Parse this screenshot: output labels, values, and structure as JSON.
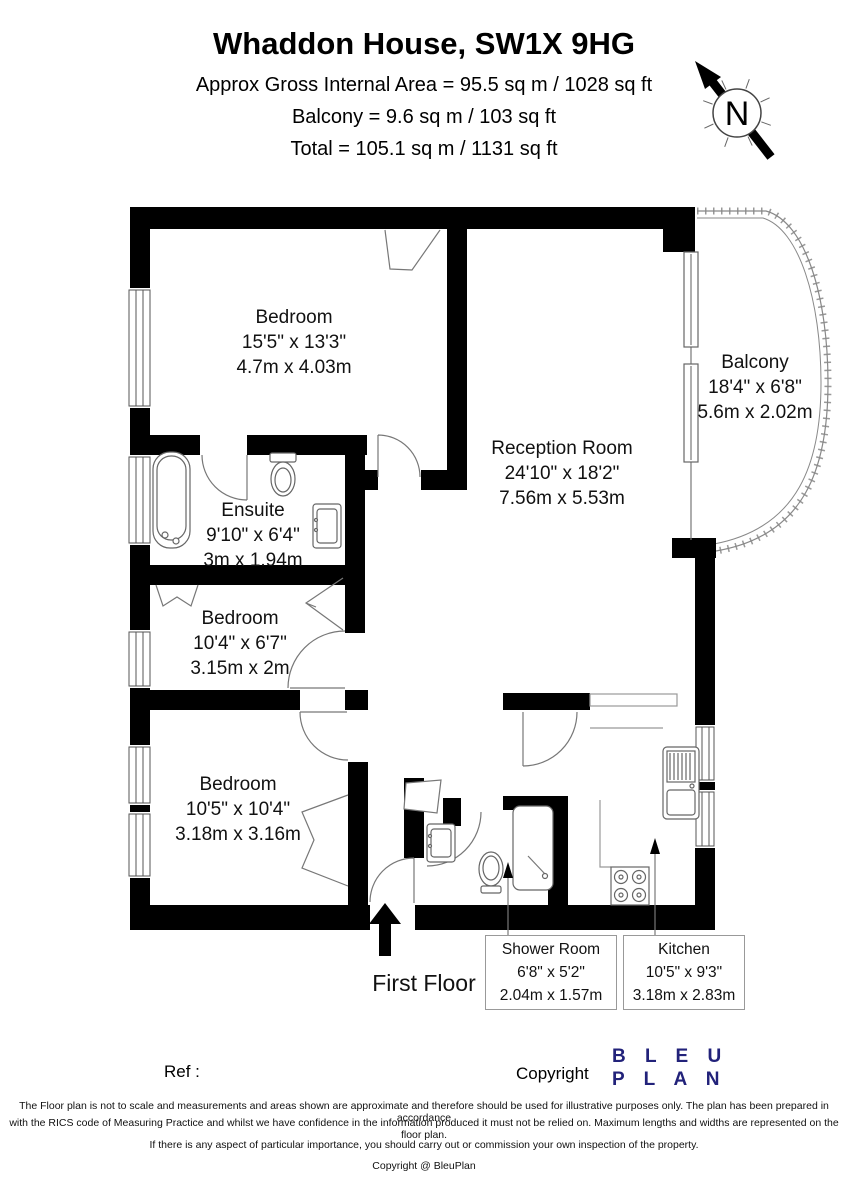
{
  "header": {
    "title": "Whaddon House, SW1X 9HG",
    "area_line1": "Approx Gross Internal Area = 95.5 sq m / 1028 sq ft",
    "area_line2": "Balcony = 9.6 sq m / 103 sq ft",
    "area_line3": "Total = 105.1 sq m / 1131 sq ft"
  },
  "compass": {
    "label": "N"
  },
  "rooms": [
    {
      "name": "Bedroom",
      "dims_imperial": "15'5\" x 13'3\"",
      "dims_metric": "4.7m x 4.03m"
    },
    {
      "name": "Reception Room",
      "dims_imperial": "24'10\" x 18'2\"",
      "dims_metric": "7.56m x 5.53m"
    },
    {
      "name": "Balcony",
      "dims_imperial": "18'4\" x 6'8\"",
      "dims_metric": "5.6m x 2.02m"
    },
    {
      "name": "Ensuite",
      "dims_imperial": "9'10\" x 6'4\"",
      "dims_metric": "3m x 1.94m"
    },
    {
      "name": "Bedroom",
      "dims_imperial": "10'4\" x 6'7\"",
      "dims_metric": "3.15m x 2m"
    },
    {
      "name": "Bedroom",
      "dims_imperial": "10'5\" x 10'4\"",
      "dims_metric": "3.18m x 3.16m"
    },
    {
      "name": "Shower Room",
      "dims_imperial": "6'8\" x 5'2\"",
      "dims_metric": "2.04m x 1.57m"
    },
    {
      "name": "Kitchen",
      "dims_imperial": "10'5\" x 9'3\"",
      "dims_metric": "3.18m x 2.83m"
    }
  ],
  "floor_label": "First Floor",
  "footer": {
    "ref_label": "Ref  :",
    "copyright_label": "Copyright",
    "logo_line1": "B L E U",
    "logo_line2": "P L A N",
    "disclaimer_line1": "The Floor plan is not to scale and measurements and areas shown are approximate and therefore should be used for illustrative purposes only. The plan has been prepared in accordance",
    "disclaimer_line2": "with the RICS code of Measuring Practice and whilst we have confidence in the information produced it must not be relied on. Maximum lengths and widths are represented on the floor plan.",
    "disclaimer_line3": "If there is any aspect of particular importance, you should carry out or commission your own inspection of the property.",
    "disclaimer_line4": "Copyright @ BleuPlan"
  },
  "colors": {
    "wall": "#000000",
    "line": "#777777",
    "logo_navy": "#22227a"
  }
}
